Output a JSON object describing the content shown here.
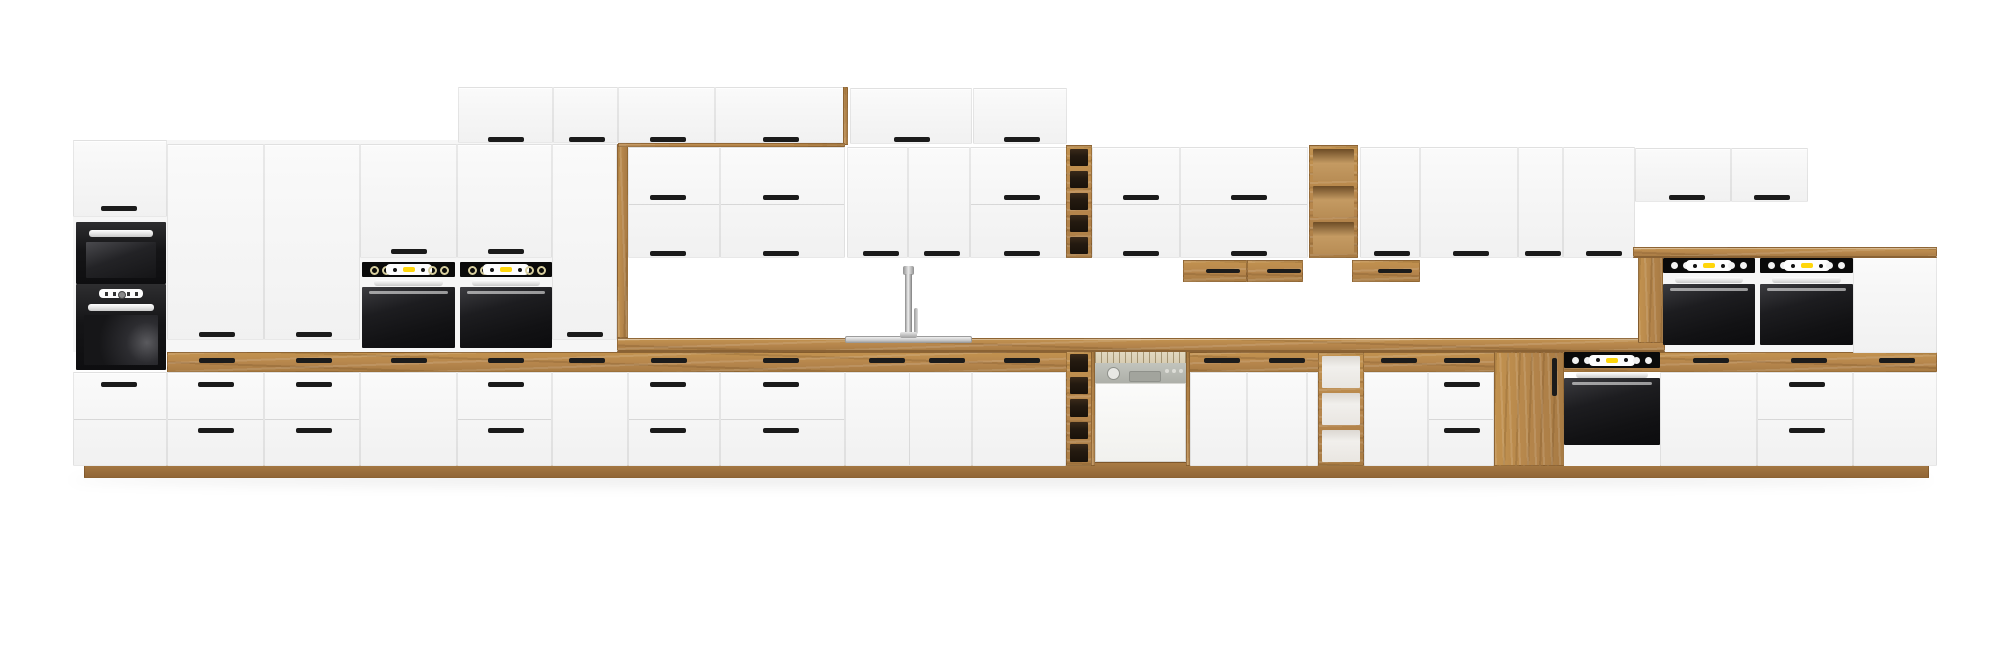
{
  "scene": {
    "description": "3D product render of a long modular kitchen set on a white background: matte white cabinet fronts with black bar handles and oak wood accents (countertop, top drawer band, plinth, open shelf units, pantry door), a tall oven tower with built-in microwave and oven, two mid-height built-in black ovens with yellow displays, sink with chrome faucet, semi-integrated dishwasher with grey control panel, small oak wall boxes, open oak shelving, a base built-in oven, and a raised right section with two black double ovens under an oak counter.",
    "canvas": {
      "w": 2000,
      "h": 662
    },
    "palette": {
      "background": "#ffffff",
      "front_white": "#f7f7f7",
      "oak": "#b5854c",
      "oak_dark": "#8a6234",
      "oak_plinth": "#a87b44",
      "handle_black": "#1b1b1b",
      "appliance_black": "#141416",
      "display_yellow": "#ffd60a",
      "knob_white": "#f2f2f2",
      "steel": "#d9d9d9",
      "dishwasher_panel": "#b6b8b1",
      "dishwasher_rack": "#d8cdb2",
      "shelf_dark_interior": "#2a1e12",
      "shelf_light_interior": "#f1efec"
    },
    "modules": [
      {
        "type": "shadow",
        "name": "floor-shadow",
        "x": 70,
        "y": 474,
        "w": 1862,
        "h": 12
      },
      {
        "type": "plinth",
        "name": "plinth",
        "x": 84,
        "y": 462,
        "w": 1845,
        "h": 16
      },
      {
        "type": "rect",
        "name": "tall-cabinet-backing",
        "x": 73,
        "y": 140,
        "w": 555,
        "h": 212,
        "c": "#f6f6f6"
      },
      {
        "type": "rect",
        "name": "raised-block-backing",
        "x": 1660,
        "y": 257,
        "w": 277,
        "h": 96,
        "c": "#f6f6f6"
      },
      {
        "type": "woodband",
        "name": "oak-drawer-band",
        "x": 167,
        "y": 352,
        "w": 1770,
        "h": 20,
        "handles": [
          [
            198,
            357
          ],
          [
            295,
            357
          ],
          [
            390,
            357
          ],
          [
            487,
            357
          ],
          [
            568,
            357
          ],
          [
            650,
            357
          ],
          [
            762,
            357
          ],
          [
            868,
            357
          ],
          [
            928,
            357
          ],
          [
            1003,
            357
          ],
          [
            1203,
            357
          ],
          [
            1268,
            357
          ],
          [
            1380,
            357
          ],
          [
            1443,
            357
          ],
          [
            1692,
            357
          ],
          [
            1790,
            357
          ],
          [
            1878,
            357
          ]
        ]
      },
      {
        "type": "front",
        "name": "base-oven-tower-drawers",
        "x": 73,
        "y": 372,
        "w": 94,
        "h": 94,
        "handles": [
          [
            100,
            381
          ]
        ],
        "hlines": [
          418
        ]
      },
      {
        "type": "front",
        "name": "base-drawer-unit",
        "x": 167,
        "y": 372,
        "w": 97,
        "h": 94,
        "handles": [
          [
            197,
            381
          ],
          [
            197,
            427
          ]
        ],
        "hlines": [
          418
        ]
      },
      {
        "type": "front",
        "name": "base-drawer-unit",
        "x": 264,
        "y": 372,
        "w": 96,
        "h": 94,
        "handles": [
          [
            295,
            381
          ],
          [
            295,
            427
          ]
        ],
        "hlines": [
          418
        ]
      },
      {
        "type": "front",
        "name": "base-door-unit",
        "x": 360,
        "y": 372,
        "w": 97,
        "h": 94
      },
      {
        "type": "front",
        "name": "base-drawer-unit",
        "x": 457,
        "y": 372,
        "w": 95,
        "h": 94,
        "handles": [
          [
            487,
            381
          ],
          [
            487,
            427
          ]
        ],
        "hlines": [
          418
        ]
      },
      {
        "type": "front",
        "name": "base-door-unit",
        "x": 552,
        "y": 372,
        "w": 76,
        "h": 94
      },
      {
        "type": "front",
        "name": "base-drawer-unit",
        "x": 628,
        "y": 372,
        "w": 92,
        "h": 94,
        "handles": [
          [
            649,
            381
          ],
          [
            649,
            427
          ]
        ],
        "hlines": [
          418
        ]
      },
      {
        "type": "front",
        "name": "base-drawer-unit",
        "x": 720,
        "y": 372,
        "w": 125,
        "h": 94,
        "handles": [
          [
            762,
            381
          ],
          [
            762,
            427
          ]
        ],
        "hlines": [
          418
        ]
      },
      {
        "type": "front",
        "name": "sink-base-doors",
        "x": 845,
        "y": 372,
        "w": 127,
        "h": 94,
        "vlines": [
          908
        ]
      },
      {
        "type": "front",
        "name": "base-door-unit",
        "x": 972,
        "y": 372,
        "w": 94,
        "h": 94
      },
      {
        "type": "front",
        "name": "base-door-unit",
        "x": 1190,
        "y": 372,
        "w": 57,
        "h": 94
      },
      {
        "type": "front",
        "name": "base-door-unit",
        "x": 1247,
        "y": 372,
        "w": 60,
        "h": 94
      },
      {
        "type": "front",
        "name": "base-filler-door",
        "x": 1307,
        "y": 372,
        "w": 11,
        "h": 94
      },
      {
        "type": "front",
        "name": "base-door-unit",
        "x": 1364,
        "y": 372,
        "w": 64,
        "h": 94
      },
      {
        "type": "front",
        "name": "base-drawer-unit",
        "x": 1428,
        "y": 372,
        "w": 66,
        "h": 94,
        "handles": [
          [
            1443,
            381
          ],
          [
            1443,
            427
          ]
        ],
        "hlines": [
          418
        ]
      },
      {
        "type": "front",
        "name": "raised-base-door",
        "x": 1660,
        "y": 372,
        "w": 97,
        "h": 94
      },
      {
        "type": "front",
        "name": "raised-base-drawers",
        "x": 1757,
        "y": 372,
        "w": 96,
        "h": 94,
        "handles": [
          [
            1788,
            381
          ],
          [
            1788,
            427
          ]
        ],
        "hlines": [
          418
        ]
      },
      {
        "type": "front",
        "name": "raised-base-door",
        "x": 1853,
        "y": 372,
        "w": 84,
        "h": 94
      },
      {
        "type": "shelf",
        "name": "base-open-shelf-narrow",
        "x": 1066,
        "y": 350,
        "w": 26,
        "h": 116,
        "cells": 5,
        "interior": "dark"
      },
      {
        "type": "shelf",
        "name": "base-open-shelf",
        "x": 1318,
        "y": 352,
        "w": 46,
        "h": 114,
        "cells": 3,
        "interior": "light"
      },
      {
        "type": "woodfront",
        "name": "pantry-oak-door",
        "x": 1494,
        "y": 352,
        "w": 70,
        "h": 114,
        "vhandle": [
          1551,
          357,
          38
        ]
      },
      {
        "type": "dishwasher",
        "name": "dishwasher",
        "x": 1091,
        "y": 350,
        "w": 99,
        "h": 116
      },
      {
        "type": "oven",
        "name": "base-built-in-oven",
        "x": 1564,
        "y": 352,
        "w": 96,
        "panelH": 16,
        "barY": 372,
        "doorY": 378,
        "doorH": 67,
        "bottomWhite": [
          445,
          21
        ],
        "style": "dots"
      },
      {
        "type": "counter",
        "name": "countertop",
        "x": 617,
        "y": 338,
        "w": 1048,
        "h": 14
      },
      {
        "type": "sink",
        "name": "sink",
        "x": 845,
        "y": 336,
        "w": 127,
        "h": 7
      },
      {
        "type": "faucet",
        "name": "faucet",
        "x": 898,
        "y": 266
      },
      {
        "type": "front",
        "name": "tower-top-door",
        "x": 73,
        "y": 140,
        "w": 94,
        "h": 77,
        "handles": [
          [
            100,
            205
          ]
        ]
      },
      {
        "type": "microwave",
        "name": "built-in-microwave",
        "x": 76,
        "y": 222,
        "w": 90,
        "h": 62
      },
      {
        "type": "toweroven",
        "name": "tower-built-in-oven",
        "x": 76,
        "y": 284,
        "w": 90,
        "h": 86
      },
      {
        "type": "front",
        "name": "tall-door",
        "x": 167,
        "y": 144,
        "w": 97,
        "h": 196,
        "handles": [
          [
            198,
            331
          ]
        ]
      },
      {
        "type": "front",
        "name": "tall-door",
        "x": 264,
        "y": 144,
        "w": 96,
        "h": 196,
        "handles": [
          [
            295,
            331
          ]
        ]
      },
      {
        "type": "front",
        "name": "over-oven-door",
        "x": 360,
        "y": 144,
        "w": 97,
        "h": 114,
        "handles": [
          [
            390,
            248
          ]
        ]
      },
      {
        "type": "front",
        "name": "over-oven-door",
        "x": 457,
        "y": 144,
        "w": 95,
        "h": 114,
        "handles": [
          [
            487,
            248
          ]
        ]
      },
      {
        "type": "front",
        "name": "tall-door",
        "x": 552,
        "y": 144,
        "w": 65,
        "h": 196,
        "handles": [
          [
            566,
            331
          ]
        ]
      },
      {
        "type": "woodv-rect",
        "name": "oak-end-panel",
        "x": 617,
        "y": 144,
        "w": 11,
        "h": 194
      },
      {
        "type": "oven",
        "name": "built-in-oven",
        "x": 362,
        "y": 262,
        "w": 93,
        "panelH": 15,
        "barY": 280,
        "doorY": 287,
        "doorH": 61,
        "style": "rings"
      },
      {
        "type": "oven",
        "name": "built-in-oven",
        "x": 460,
        "y": 262,
        "w": 92,
        "panelH": 15,
        "barY": 280,
        "doorY": 287,
        "doorH": 61,
        "style": "rings"
      },
      {
        "type": "front",
        "name": "top-wall-door",
        "x": 458,
        "y": 87,
        "w": 95,
        "h": 56,
        "handles": [
          [
            487,
            136
          ]
        ]
      },
      {
        "type": "front",
        "name": "top-wall-door",
        "x": 553,
        "y": 87,
        "w": 65,
        "h": 56,
        "handles": [
          [
            568,
            136
          ]
        ]
      },
      {
        "type": "front",
        "name": "top-wall-door",
        "x": 618,
        "y": 87,
        "w": 97,
        "h": 56,
        "handles": [
          [
            649,
            136
          ]
        ]
      },
      {
        "type": "front",
        "name": "top-wall-door",
        "x": 715,
        "y": 87,
        "w": 130,
        "h": 56,
        "handles": [
          [
            762,
            136
          ]
        ]
      },
      {
        "type": "woodv-rect",
        "name": "oak-top-sliver",
        "x": 843,
        "y": 87,
        "w": 5,
        "h": 58
      },
      {
        "type": "wood-rect",
        "name": "oak-shelf-strip",
        "x": 618,
        "y": 143,
        "w": 227,
        "h": 4
      },
      {
        "type": "front",
        "name": "top-wall-door",
        "x": 850,
        "y": 88,
        "w": 122,
        "h": 56,
        "handles": [
          [
            893,
            136
          ]
        ]
      },
      {
        "type": "front",
        "name": "top-wall-door",
        "x": 973,
        "y": 88,
        "w": 94,
        "h": 56,
        "handles": [
          [
            1003,
            136
          ]
        ]
      },
      {
        "type": "front",
        "name": "wall-stacked-doors",
        "x": 628,
        "y": 147,
        "w": 92,
        "h": 111,
        "handles": [
          [
            649,
            194
          ],
          [
            649,
            250
          ]
        ],
        "hlines": [
          203
        ]
      },
      {
        "type": "front",
        "name": "wall-stacked-doors",
        "x": 720,
        "y": 147,
        "w": 125,
        "h": 111,
        "handles": [
          [
            762,
            194
          ],
          [
            762,
            250
          ]
        ],
        "hlines": [
          203
        ]
      },
      {
        "type": "front",
        "name": "wall-tall-door",
        "x": 847,
        "y": 147,
        "w": 61,
        "h": 111,
        "handles": [
          [
            862,
            250
          ]
        ]
      },
      {
        "type": "front",
        "name": "wall-tall-door",
        "x": 908,
        "y": 147,
        "w": 62,
        "h": 111,
        "handles": [
          [
            923,
            250
          ]
        ]
      },
      {
        "type": "front",
        "name": "wall-stacked-doors",
        "x": 970,
        "y": 147,
        "w": 97,
        "h": 111,
        "handles": [
          [
            1003,
            194
          ],
          [
            1003,
            250
          ]
        ],
        "hlines": [
          203
        ]
      },
      {
        "type": "shelf",
        "name": "wall-open-shelf-narrow",
        "x": 1066,
        "y": 145,
        "w": 26,
        "h": 113,
        "cells": 5,
        "interior": "dark"
      },
      {
        "type": "front",
        "name": "wall-stacked-doors",
        "x": 1092,
        "y": 147,
        "w": 88,
        "h": 111,
        "handles": [
          [
            1122,
            194
          ],
          [
            1122,
            250
          ]
        ],
        "hlines": [
          203
        ]
      },
      {
        "type": "front",
        "name": "wall-stacked-doors",
        "x": 1180,
        "y": 147,
        "w": 128,
        "h": 111,
        "handles": [
          [
            1230,
            194
          ],
          [
            1230,
            250
          ]
        ],
        "hlines": [
          203
        ]
      },
      {
        "type": "shelf",
        "name": "wall-open-shelf",
        "x": 1309,
        "y": 145,
        "w": 49,
        "h": 113,
        "cells": 3,
        "interior": "wood"
      },
      {
        "type": "front",
        "name": "wall-tall-door",
        "x": 1360,
        "y": 147,
        "w": 60,
        "h": 111,
        "handles": [
          [
            1373,
            250
          ]
        ]
      },
      {
        "type": "front",
        "name": "wall-tall-door",
        "x": 1420,
        "y": 147,
        "w": 98,
        "h": 111,
        "handles": [
          [
            1452,
            250
          ]
        ]
      },
      {
        "type": "front",
        "name": "wall-tall-door",
        "x": 1518,
        "y": 147,
        "w": 45,
        "h": 111,
        "handles": [
          [
            1524,
            250
          ]
        ]
      },
      {
        "type": "front",
        "name": "wall-tall-door",
        "x": 1563,
        "y": 147,
        "w": 72,
        "h": 111,
        "handles": [
          [
            1585,
            250
          ]
        ]
      },
      {
        "type": "front",
        "name": "top-right-wall-door",
        "x": 1635,
        "y": 148,
        "w": 96,
        "h": 54,
        "handles": [
          [
            1668,
            194
          ]
        ]
      },
      {
        "type": "front",
        "name": "top-right-wall-door",
        "x": 1731,
        "y": 148,
        "w": 77,
        "h": 54,
        "handles": [
          [
            1753,
            194
          ]
        ]
      },
      {
        "type": "woodbox",
        "name": "oak-wall-box",
        "x": 1183,
        "y": 260,
        "w": 64,
        "h": 22,
        "handle": [
          1205,
          268
        ]
      },
      {
        "type": "woodbox",
        "name": "oak-wall-box",
        "x": 1247,
        "y": 260,
        "w": 56,
        "h": 22,
        "handle": [
          1266,
          268
        ]
      },
      {
        "type": "woodbox",
        "name": "oak-wall-box",
        "x": 1352,
        "y": 260,
        "w": 68,
        "h": 22,
        "handle": [
          1377,
          268
        ]
      },
      {
        "type": "woodv-rect",
        "name": "raised-oak-side-panel",
        "x": 1638,
        "y": 257,
        "w": 25,
        "h": 86
      },
      {
        "type": "front",
        "name": "raised-tall-door",
        "x": 1853,
        "y": 257,
        "w": 84,
        "h": 96
      },
      {
        "type": "oven",
        "name": "double-oven",
        "x": 1663,
        "y": 258,
        "w": 92,
        "panelH": 15,
        "barY": 277,
        "doorY": 284,
        "doorH": 61,
        "style": "dots"
      },
      {
        "type": "oven",
        "name": "double-oven",
        "x": 1760,
        "y": 258,
        "w": 93,
        "panelH": 15,
        "barY": 277,
        "doorY": 284,
        "doorH": 61,
        "style": "dots"
      },
      {
        "type": "counter",
        "name": "raised-countertop",
        "x": 1633,
        "y": 247,
        "w": 304,
        "h": 11
      }
    ]
  }
}
